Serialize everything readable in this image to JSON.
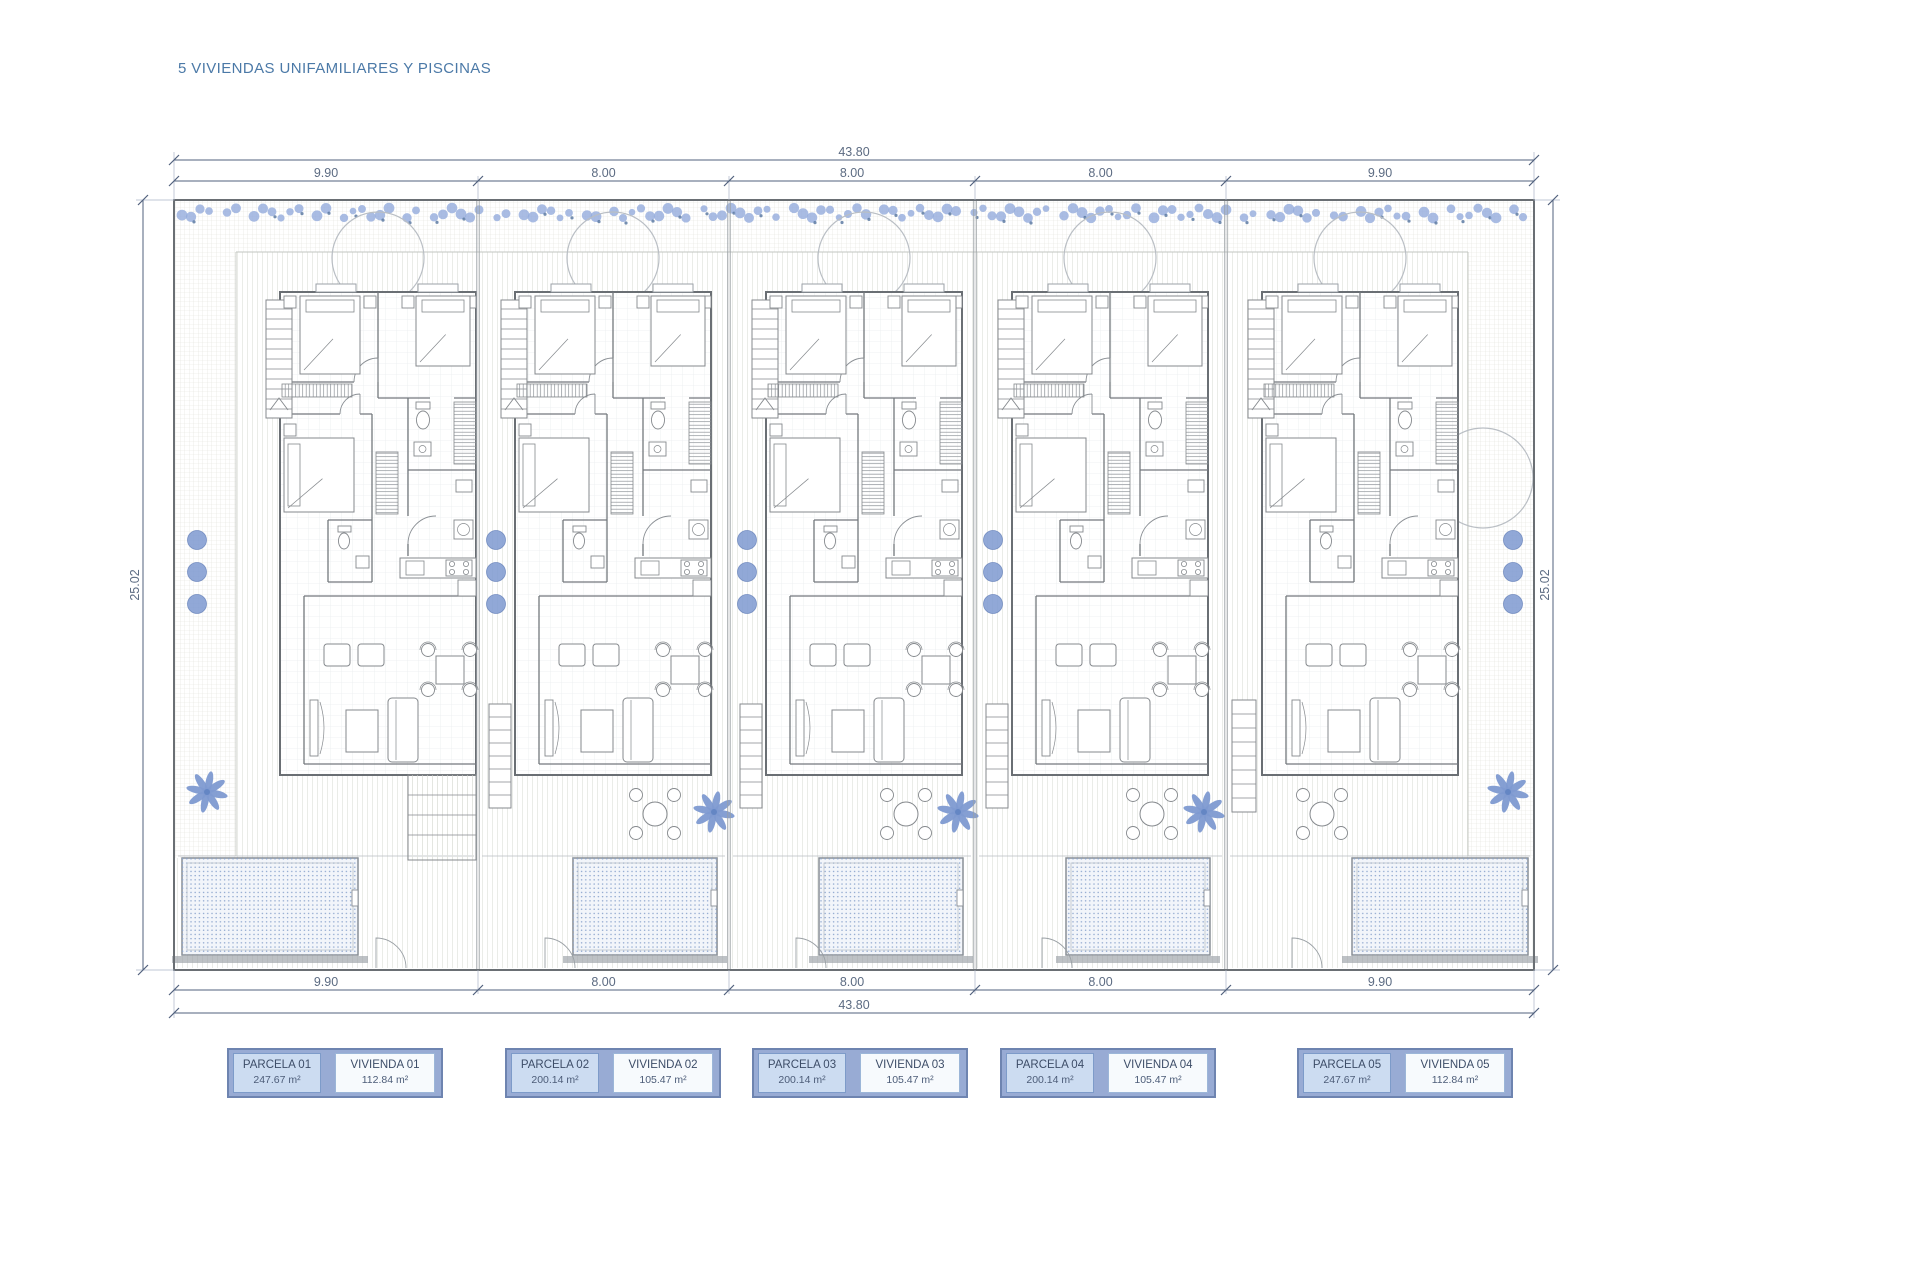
{
  "title": "5 VIVIENDAS UNIFAMILIARES Y PISCINAS",
  "dimensions": {
    "total_top": "43.80",
    "total_bottom": "43.80",
    "segments_top": [
      "9.90",
      "8.00",
      "8.00",
      "8.00",
      "9.90"
    ],
    "segments_bottom": [
      "9.90",
      "8.00",
      "8.00",
      "8.00",
      "9.90"
    ],
    "side_left": "25.02",
    "side_right": "25.02"
  },
  "parcels": [
    {
      "parcela_label": "PARCELA 01",
      "parcela_area": "247.67 m²",
      "vivienda_label": "VIVIENDA 01",
      "vivienda_area": "112.84 m²"
    },
    {
      "parcela_label": "PARCELA 02",
      "parcela_area": "200.14 m²",
      "vivienda_label": "VIVIENDA 02",
      "vivienda_area": "105.47 m²"
    },
    {
      "parcela_label": "PARCELA 03",
      "parcela_area": "200.14 m²",
      "vivienda_label": "VIVIENDA 03",
      "vivienda_area": "105.47 m²"
    },
    {
      "parcela_label": "PARCELA 04",
      "parcela_area": "200.14 m²",
      "vivienda_label": "VIVIENDA 04",
      "vivienda_area": "105.47 m²"
    },
    {
      "parcela_label": "PARCELA 05",
      "parcela_area": "247.67 m²",
      "vivienda_label": "VIVIENDA 05",
      "vivienda_area": "112.84 m²"
    }
  ],
  "colors": {
    "title_text": "#4b79a7",
    "dimension": "#5c6b82",
    "plant_blue": "#7e9ad1",
    "plant_blue_dark": "#6486c4",
    "pool_dot": "#8fa7cf",
    "wall_gray": "#73787d",
    "outline_gray": "#6a6f74",
    "furniture_gray": "#85898d",
    "legend_container": "#98abd4",
    "legend_container_border": "#6e84b0",
    "legend_parcela_fill": "#ccdcf1",
    "legend_vivienda_fill": "#f7fafd",
    "legend_text": "#3d4d68"
  }
}
